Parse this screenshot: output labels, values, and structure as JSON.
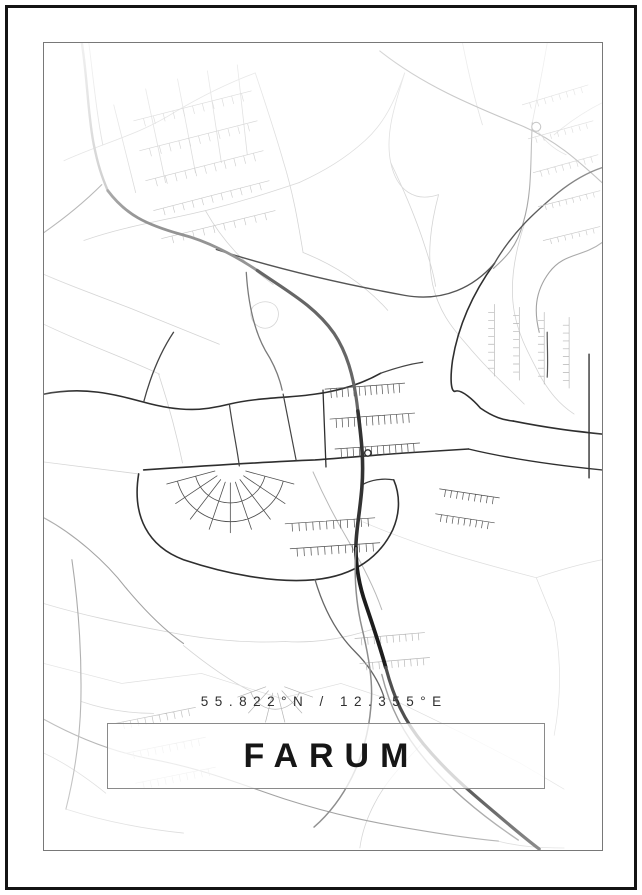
{
  "poster": {
    "coordinates": "55.822°N / 12.355°E",
    "title": "FARUM"
  },
  "colors": {
    "background": "#ffffff",
    "frame": "#141414",
    "map_border": "#787878",
    "box_border": "#8a8a8a",
    "title_text": "#161616",
    "coords_text": "#2f2f2f",
    "road_light": "#d4d4d4",
    "road_medium": "#a2a2a2",
    "road_dark": "#2e2e2e",
    "motorway_dark": "#1d1d1d"
  },
  "map": {
    "viewbox": "0 0 560 809",
    "roads": [
      {
        "d": "M20,118 C60,100 95,92 130,70 C160,52 185,40 212,30"
      },
      {
        "d": "M40,198 C80,184 120,178 162,168 C202,158 232,148 256,140"
      },
      {
        "d": "M70,62 L92,150"
      },
      {
        "d": "M102,46 L122,140"
      },
      {
        "d": "M134,36 L152,130"
      },
      {
        "d": "M164,28 L178,120"
      },
      {
        "d": "M194,22 L204,112"
      },
      {
        "d": "M256,140 C282,128 302,116 322,98 C342,80 352,58 362,30"
      },
      {
        "d": "M362,30 C352,62 342,92 348,120 C354,148 372,160 396,152"
      },
      {
        "d": "M396,152 C388,182 384,212 390,242 C396,268 408,284 424,302 C444,326 462,342 482,362"
      },
      {
        "d": "M482,182 C472,212 467,242 472,270 C477,296 487,312 497,332 C507,350 517,362 532,372"
      },
      {
        "d": "M348,120 C360,145 370,168 379,194 C387,218 391,231 393,244"
      },
      {
        "d": "M0,232 C32,246 62,256 92,268 C122,280 152,292 176,302"
      },
      {
        "d": "M0,282 C42,302 82,316 116,332"
      },
      {
        "d": "M162,168 C180,200 202,222 230,242"
      },
      {
        "d": "M212,30 C222,60 232,90 240,118"
      },
      {
        "d": "M240,118 C250,150 255,180 260,210"
      },
      {
        "d": "M260,210 C290,222 320,240 345,268"
      },
      {
        "d": "M505,0 C500,30 495,55 490,80"
      },
      {
        "d": "M420,0 C426,30 432,56 440,82"
      },
      {
        "d": "M210,264 C220,256 233,259 235,269 C237,280 227,289 217,285 C208,281 205,271 210,264"
      },
      {
        "d": "M0,562 C40,574 80,582 122,590 C162,598 202,602 242,600"
      },
      {
        "d": "M140,604 C162,622 184,638 208,650"
      },
      {
        "d": "M242,600 C272,602 302,597 332,587"
      },
      {
        "d": "M0,622 L78,642 L158,632 L238,657 L298,642",
        "c": "#dedede",
        "w": 0.7
      },
      {
        "d": "M298,642 L358,662 L420,692 L478,722 L522,748",
        "c": "#dedede",
        "w": 0.7
      },
      {
        "d": "M320,480 C380,506 440,522 494,536",
        "c": "#dedede",
        "w": 0.7
      },
      {
        "d": "M494,536 L512,580 C520,622 518,662 512,694",
        "c": "#dedede",
        "w": 0.7
      },
      {
        "d": "M494,536 C518,528 540,522 560,518",
        "c": "#dedede",
        "w": 0.7
      },
      {
        "d": "M0,712 C22,722 42,736 62,752"
      },
      {
        "d": "M380,702 C360,722 342,742 332,762 C324,777 319,792 317,807"
      },
      {
        "d": "M455,800 C478,806 500,807 522,807"
      },
      {
        "d": "M115,332 C125,362 133,392 139,421"
      },
      {
        "d": "M0,420 C32,424 62,428 95,432"
      },
      {
        "d": "M22,768 C60,780 100,788 140,792"
      },
      {
        "d": "M560,60 C540,70 526,80 512,92"
      },
      {
        "d": "M490,80 C500,96 510,106 524,112"
      },
      {
        "d": "M37,660 C60,668 85,672 110,672"
      },
      {
        "d": "M337,8 C380,42 428,62 477,82 C512,96 536,118 560,140",
        "c": "#a2a2a2",
        "w": 1.1
      },
      {
        "d": "M490,80 C488,120 490,150 481,180 C474,206 462,216 451,226",
        "c": "#a2a2a2",
        "w": 1.1
      },
      {
        "d": "M58,142 C40,160 20,176 0,190",
        "c": "#a2a2a2",
        "w": 1.1
      },
      {
        "d": "M28,518 C34,560 38,610 37,660 C36,702 29,740 22,768",
        "c": "#a2a2a2",
        "w": 1.1
      },
      {
        "d": "M0,678 C40,700 76,712 108,718 C162,728 202,745 242,758 C292,774 332,782 382,790 C412,795 434,798 456,800",
        "c": "#a2a2a2",
        "w": 1.1
      },
      {
        "d": "M0,476 C30,492 62,520 82,546 C102,570 120,588 140,602",
        "c": "#a2a2a2",
        "w": 1.1
      },
      {
        "d": "M560,200 C540,215 522,210 507,230 C492,250 492,270 497,290",
        "c": "#a2a2a2",
        "w": 1.1
      },
      {
        "d": "M203,230 C205,262 211,288 222,308 C231,322 236,334 239,348",
        "c": "#7a7a7a",
        "w": 1.3
      },
      {
        "d": "M270,430 C281,455 293,478 306,500 C319,522 331,545 339,568",
        "c": "#b8b8b8",
        "w": 1.0
      },
      {
        "d": "M0,352 C40,344 70,352 100,360 C140,371 162,368 186,362 C216,355 246,356 272,352 C302,348 322,340 338,331",
        "c": "#2e2e2e",
        "w": 1.6
      },
      {
        "d": "M452,221 C431,250 416,282 410,318 C407,340 409,351 413,349 C419,347 431,358 438,366 C451,375 461,378 471,379",
        "c": "#2e2e2e",
        "w": 1.6
      },
      {
        "d": "M471,379 C506,386 531,389 560,392",
        "c": "#2e2e2e",
        "w": 1.6
      },
      {
        "d": "M547,312 L547,436",
        "c": "#2e2e2e",
        "w": 1.4
      },
      {
        "d": "M100,428 C160,424 222,420 272,418 C302,416 332,413 362,411 C392,409 412,408 426,407",
        "c": "#2e2e2e",
        "w": 1.6
      },
      {
        "d": "M280,348 L283,425",
        "c": "#2e2e2e",
        "w": 1.3
      },
      {
        "d": "M95,432 C88,475 105,505 140,518 C182,532 232,542 272,538 C312,534 337,515 350,488 C358,470 357,452 351,438",
        "c": "#2e2e2e",
        "w": 1.6
      },
      {
        "d": "M173,207 C232,226 302,242 362,253 C402,260 432,244 452,221",
        "c": "#555555",
        "w": 1.4
      },
      {
        "d": "M240,352 C246,382 250,402 253,418",
        "c": "#444444",
        "w": 1.2
      },
      {
        "d": "M272,538 C280,565 292,590 312,610 C326,624 336,640 341,655",
        "c": "#666666",
        "w": 1.3
      },
      {
        "d": "M426,407 C472,418 520,424 560,428",
        "c": "#2e2e2e",
        "w": 1.4
      },
      {
        "d": "M452,221 C470,190 492,170 516,150 C536,134 551,128 560,125",
        "c": "#555555",
        "w": 1.4
      },
      {
        "d": "M100,360 C108,330 118,308 130,290",
        "c": "#444444",
        "w": 1.3
      },
      {
        "d": "M186,362 C190,390 194,408 196,424",
        "c": "#444444",
        "w": 1.2
      },
      {
        "d": "M351,438 C340,436 328,438 319,443",
        "c": "#3a3a3a",
        "w": 1.3
      },
      {
        "d": "M338,331 C352,326 366,322 380,320",
        "c": "#444444",
        "w": 1.3
      },
      {
        "d": "M505,290 C505,305 506,320 505,335",
        "c": "#555555",
        "w": 1.2
      }
    ],
    "ladders": [
      {
        "s": [
          90,
          78,
          208,
          48
        ],
        "n": 11,
        "len": 8,
        "c": "#c6c6c6",
        "w": 0.65
      },
      {
        "s": [
          96,
          108,
          214,
          78
        ],
        "n": 11,
        "len": 8,
        "c": "#c6c6c6",
        "w": 0.65
      },
      {
        "s": [
          102,
          138,
          220,
          108
        ],
        "n": 11,
        "len": 8,
        "c": "#c6c6c6",
        "w": 0.65
      },
      {
        "s": [
          110,
          168,
          226,
          138
        ],
        "n": 11,
        "len": 7,
        "c": "#c6c6c6",
        "w": 0.65
      },
      {
        "s": [
          118,
          196,
          232,
          168
        ],
        "n": 10,
        "len": 7,
        "c": "#c6c6c6",
        "w": 0.65
      },
      {
        "s": [
          480,
          62,
          546,
          42
        ],
        "n": 8,
        "len": 6,
        "c": "#c0c0c0",
        "w": 0.65
      },
      {
        "s": [
          486,
          96,
          551,
          78
        ],
        "n": 8,
        "len": 6,
        "c": "#c0c0c0",
        "w": 0.65
      },
      {
        "s": [
          491,
          130,
          556,
          112
        ],
        "n": 8,
        "len": 6,
        "c": "#c0c0c0",
        "w": 0.65
      },
      {
        "s": [
          496,
          164,
          558,
          148
        ],
        "n": 8,
        "len": 5,
        "c": "#c0c0c0",
        "w": 0.65
      },
      {
        "s": [
          501,
          198,
          558,
          184
        ],
        "n": 7,
        "len": 5,
        "c": "#c0c0c0",
        "w": 0.65
      },
      {
        "s": [
          452,
          262,
          452,
          334
        ],
        "n": 8,
        "len": 6,
        "c": "#b5b5b5",
        "w": 0.65
      },
      {
        "s": [
          477,
          265,
          477,
          338
        ],
        "n": 8,
        "len": 6,
        "c": "#b5b5b5",
        "w": 0.65
      },
      {
        "s": [
          502,
          270,
          502,
          342
        ],
        "n": 8,
        "len": 6,
        "c": "#b5b5b5",
        "w": 0.65
      },
      {
        "s": [
          527,
          275,
          527,
          346
        ],
        "n": 8,
        "len": 6,
        "c": "#b5b5b5",
        "w": 0.65
      },
      {
        "s": [
          282,
          347,
          362,
          341
        ],
        "n": 13,
        "len": 9,
        "c": "#4f4f4f",
        "w": 0.7
      },
      {
        "s": [
          287,
          377,
          372,
          371
        ],
        "n": 13,
        "len": 9,
        "c": "#4f4f4f",
        "w": 0.7
      },
      {
        "s": [
          292,
          407,
          377,
          401
        ],
        "n": 13,
        "len": 9,
        "c": "#4f4f4f",
        "w": 0.7
      },
      {
        "s": [
          242,
          482,
          332,
          476
        ],
        "n": 12,
        "len": 8,
        "c": "#4f4f4f",
        "w": 0.7
      },
      {
        "s": [
          247,
          507,
          337,
          501
        ],
        "n": 12,
        "len": 8,
        "c": "#4f4f4f",
        "w": 0.7
      },
      {
        "s": [
          397,
          447,
          457,
          456
        ],
        "n": 9,
        "len": 7,
        "c": "#4f4f4f",
        "w": 0.7
      },
      {
        "s": [
          393,
          472,
          452,
          481
        ],
        "n": 9,
        "len": 7,
        "c": "#4f4f4f",
        "w": 0.7
      },
      {
        "s": [
          312,
          597,
          382,
          591
        ],
        "n": 10,
        "len": 7,
        "c": "#b8b8b8",
        "w": 0.7
      },
      {
        "s": [
          317,
          622,
          387,
          616
        ],
        "n": 10,
        "len": 7,
        "c": "#b8b8b8",
        "w": 0.7
      },
      {
        "s": [
          72,
          682,
          152,
          666
        ],
        "n": 10,
        "len": 7,
        "c": "#c2c2c2",
        "w": 0.7
      },
      {
        "s": [
          82,
          712,
          162,
          696
        ],
        "n": 10,
        "len": 7,
        "c": "#c2c2c2",
        "w": 0.7
      },
      {
        "s": [
          92,
          742,
          172,
          726
        ],
        "n": 10,
        "len": 7,
        "c": "#c2c2c2",
        "w": 0.7
      }
    ],
    "fans": [
      {
        "cx": 187,
        "cy": 425,
        "r1": 16,
        "r2": 66,
        "rays": 9,
        "a1": 15,
        "a2": 165,
        "arcs": [
          36,
          55
        ],
        "c": "#4f4f4f",
        "w": 0.8
      },
      {
        "cx": 232,
        "cy": 642,
        "r1": 10,
        "r2": 40,
        "rays": 6,
        "a1": 20,
        "a2": 160,
        "arcs": [
          26
        ],
        "c": "#b5b5b5",
        "w": 0.7
      }
    ],
    "highways": [
      {
        "d": "M38,0 C44,40 44,72 50,102 C54,122 58,134 64,148",
        "c": "#c0c0c0",
        "w": 2.4
      },
      {
        "d": "M45,0 C50,40 53,72 59,102",
        "c": "#cfcfcf",
        "w": 0.9
      },
      {
        "d": "M64,148 C82,172 102,182 138,192 C162,198 190,212 214,228",
        "c": "#949494",
        "w": 2.8
      },
      {
        "d": "M214,228 C246,250 272,264 291,291 C303,309 311,332 315,369",
        "c": "#666666",
        "w": 3.2
      },
      {
        "d": "M315,369 C319,400 321,421 319,446 C317,471 313,489 313,506",
        "c": "#333333",
        "w": 3.6
      },
      {
        "d": "M313,506 C313,526 317,546 323,563 C329,581 336,601 343,626",
        "c": "#1d1d1d",
        "w": 3.8
      },
      {
        "d": "M343,626 C351,656 361,679 381,703 C401,727 421,745 446,766 C466,783 481,796 497,808",
        "c": "#4f4f4f",
        "w": 3.2
      },
      {
        "d": "M313,506 C311,536 313,561 319,586 C325,611 331,641 328,666 C326,691 319,716 309,736 C299,756 286,773 271,786",
        "c": "#8d8d8d",
        "w": 1.5
      },
      {
        "d": "M339,633 C347,666 361,693 383,719 C405,745 437,773 476,799",
        "c": "#9d9d9d",
        "w": 1.4
      }
    ],
    "circles": [
      {
        "cx": 325,
        "cy": 411,
        "r": 3.2,
        "c": "#2e2e2e",
        "w": 1.4
      },
      {
        "cx": 494,
        "cy": 84,
        "r": 4.5,
        "c": "#a2a2a2",
        "w": 1.1
      }
    ]
  }
}
